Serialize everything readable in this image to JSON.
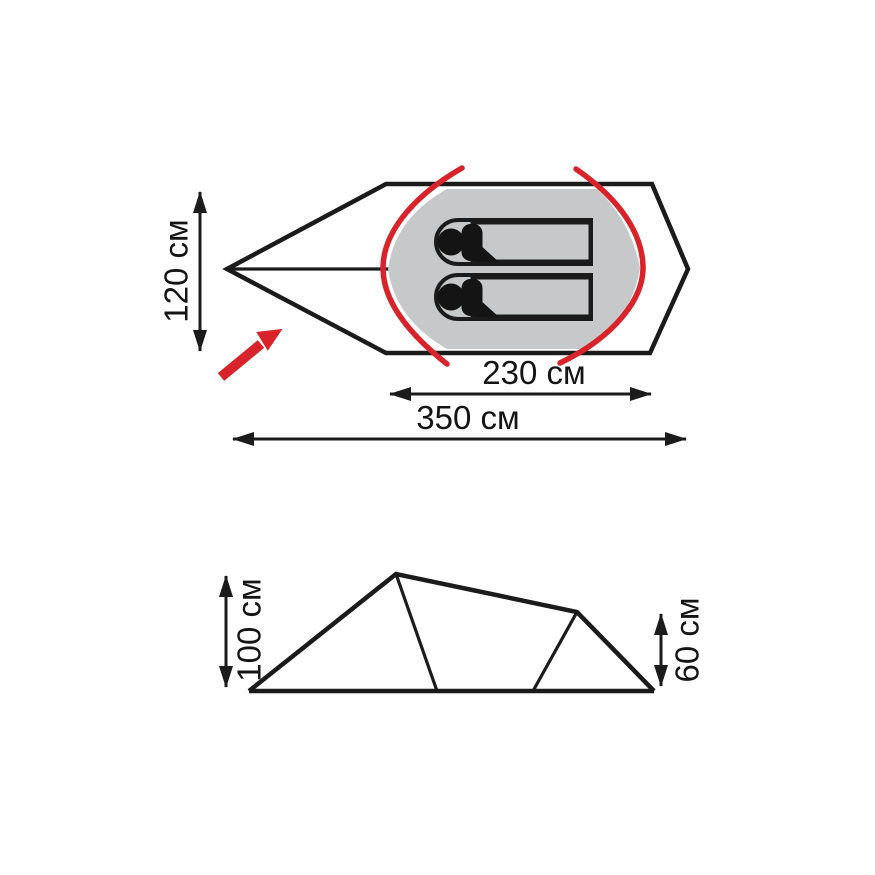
{
  "diagram": {
    "title": "tent-dimensions-diagram",
    "unit": "см",
    "colors": {
      "outline_black": "#1b1b1b",
      "pole_red": "#d8232a",
      "floor_gray": "#c7c8c9",
      "mat_white": "#ffffff"
    },
    "top_view": {
      "name": "top-view-plan",
      "occupant_count": 2,
      "dimensions": {
        "width": {
          "label": "120 см",
          "value": 120,
          "unit": "см"
        },
        "inner_length": {
          "label": "230 см",
          "value": 230,
          "unit": "см"
        },
        "total_length": {
          "label": "350 см",
          "value": 350,
          "unit": "см"
        }
      }
    },
    "side_view": {
      "name": "side-view-profile",
      "dimensions": {
        "peak_height": {
          "label": "100 см",
          "value": 100,
          "unit": "см"
        },
        "rear_height": {
          "label": "60 см",
          "value": 60,
          "unit": "см"
        }
      }
    }
  }
}
